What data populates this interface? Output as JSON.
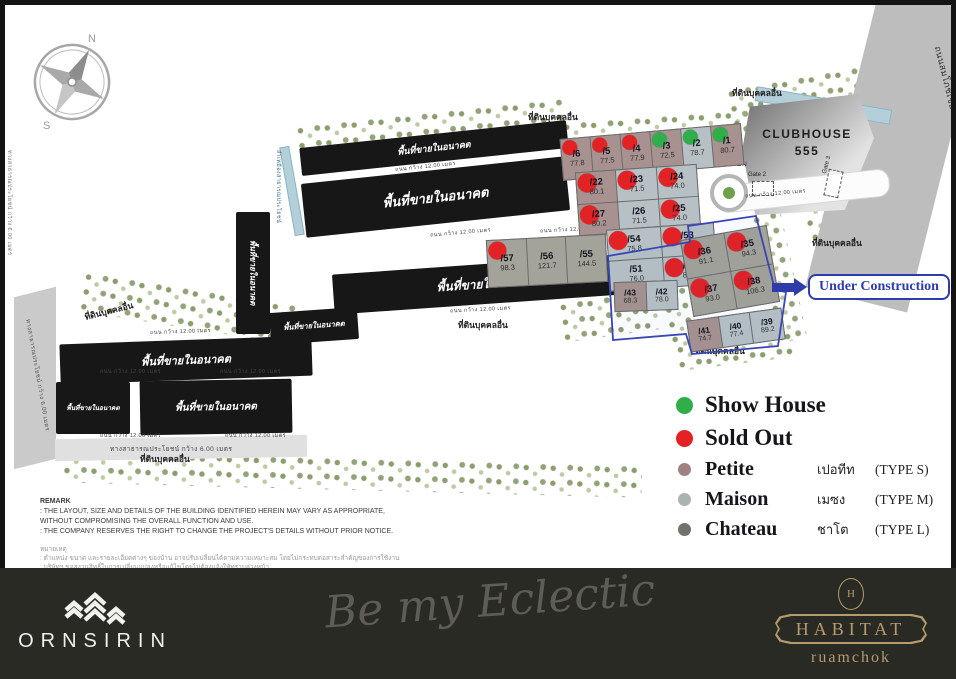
{
  "colors": {
    "show_house": "#2fae4a",
    "sold_out": "#e32226",
    "petite": "#9c8380",
    "maison": "#aab3af",
    "chateau": "#72726c",
    "under_construction": "#2e3bab",
    "habitat_gold": "#b59b6d"
  },
  "map": {
    "compass": {
      "n": "N",
      "s": "S"
    },
    "clubhouse": {
      "name": "CLUBHOUSE",
      "number": "555"
    },
    "garden": "GARDEN",
    "gate2": "Gate 2",
    "gate3": "Gate 3",
    "labels": {
      "other_land": "ที่ดินบุคคลอื่น",
      "future_area": "พื้นที่ขายในอนาคต",
      "internal_road": "ถนน กว้าง 12.00 เมตร",
      "public_way": "ทางสาธารณประโยชน์ กว้าง 6.00 เมตร",
      "main_road": "ถนนสมโภชเชียงใหม่ 700 ปี (ชม.3029)",
      "canal": "ลำเหมืองสาธารณประโยชน์",
      "under_construction": "Under Construction"
    },
    "clusters": [
      {
        "plots": [
          {
            "no": "/6",
            "area": "77.8",
            "status": "sold",
            "type": "petite"
          },
          {
            "no": "/5",
            "area": "77.5",
            "status": "sold",
            "type": "petite"
          },
          {
            "no": "/4",
            "area": "77.9",
            "status": "sold",
            "type": "petite"
          },
          {
            "no": "/3",
            "area": "72.5",
            "status": "show",
            "type": "petite"
          },
          {
            "no": "/2",
            "area": "78.7",
            "status": "show",
            "type": "maison"
          },
          {
            "no": "/1",
            "area": "80.7",
            "status": "show",
            "type": "petite"
          }
        ]
      },
      {
        "plots": [
          {
            "no": "/22",
            "area": "80.1",
            "status": "sold",
            "type": "petite"
          },
          {
            "no": "/23",
            "area": "71.5",
            "status": "sold",
            "type": "maison"
          },
          {
            "no": "/24",
            "area": "74.0",
            "status": "sold",
            "type": "maison"
          },
          {
            "no": "/27",
            "area": "80.2",
            "status": "sold",
            "type": "petite"
          },
          {
            "no": "/26",
            "area": "71.5",
            "status": "none",
            "type": "maison"
          },
          {
            "no": "/25",
            "area": "74.0",
            "status": "sold",
            "type": "maison"
          }
        ]
      },
      {
        "plots": [
          {
            "no": "/57",
            "area": "98.3",
            "status": "sold",
            "type": "chateau"
          },
          {
            "no": "/56",
            "area": "121.7",
            "status": "none",
            "type": "chateau"
          },
          {
            "no": "/55",
            "area": "144.5",
            "status": "none",
            "type": "chateau"
          }
        ]
      },
      {
        "plots": [
          {
            "no": "/54",
            "area": "75.8",
            "status": "sold",
            "type": "maison"
          },
          {
            "no": "/53",
            "area": "84.0",
            "status": "sold",
            "type": "maison"
          },
          {
            "no": "/51",
            "area": "76.0",
            "status": "none",
            "type": "maison"
          },
          {
            "no": "/52",
            "area": "83.9",
            "status": "sold",
            "type": "maison"
          }
        ]
      },
      {
        "plots": [
          {
            "no": "/43",
            "area": "68.3",
            "status": "none",
            "type": "petite"
          },
          {
            "no": "/42",
            "area": "78.0",
            "status": "none",
            "type": "maison"
          }
        ]
      },
      {
        "plots": [
          {
            "no": "/36",
            "area": "91.1",
            "status": "sold",
            "type": "chateau"
          },
          {
            "no": "/35",
            "area": "94.3",
            "status": "sold",
            "type": "chateau"
          },
          {
            "no": "/37",
            "area": "93.0",
            "status": "sold",
            "type": "chateau"
          },
          {
            "no": "/38",
            "area": "106.3",
            "status": "sold",
            "type": "chateau"
          }
        ]
      },
      {
        "plots": [
          {
            "no": "/41",
            "area": "74.7",
            "status": "none",
            "type": "petite"
          },
          {
            "no": "/40",
            "area": "77.4",
            "status": "none",
            "type": "maison"
          },
          {
            "no": "/39",
            "area": "89.2",
            "status": "none",
            "type": "maison"
          }
        ]
      }
    ]
  },
  "legend": {
    "items": [
      {
        "label": "Show House",
        "thai": "",
        "type": ""
      },
      {
        "label": "Sold Out",
        "thai": "",
        "type": ""
      },
      {
        "label": "Petite",
        "thai": "เปอทีท",
        "type": "(TYPE S)"
      },
      {
        "label": "Maison",
        "thai": "เมซง",
        "type": "(TYPE M)"
      },
      {
        "label": "Chateau",
        "thai": "ชาโต",
        "type": "(TYPE L)"
      }
    ]
  },
  "remark": {
    "title": "REMARK",
    "lines": [
      ": THE LAYOUT, SIZE AND DETAILS OF THE BUILDING IDENTIFIED HEREIN MAY VARY AS APPROPRIATE,",
      "  WITHOUT COMPROMISING THE OVERALL FUNCTION AND USE.",
      ": THE COMPANY RESERVES THE RIGHT TO CHANGE THE PROJECT'S DETAILS WITHOUT PRIOR NOTICE."
    ],
    "thai_title": "หมายเหตุ",
    "thai_lines": [
      ": ตำแหน่ง ขนาด และรายละเอียดต่างๆ ของบ้าน อาจปรับเปลี่ยนได้ตามความเหมาะสม โดยไม่กระทบต่อสาระสำคัญของการใช้งาน",
      ": บริษัทฯ ขอสงวนสิทธิ์ในการเปลี่ยนแปลงหรือแก้ไขโดยไม่ต้องแจ้งให้ทราบล่วงหน้า"
    ]
  },
  "footer": {
    "brand": "ORNSIRIN",
    "tagline": "Be my Eclectic",
    "logo": "HABITAT",
    "sub": "ruamchok"
  }
}
